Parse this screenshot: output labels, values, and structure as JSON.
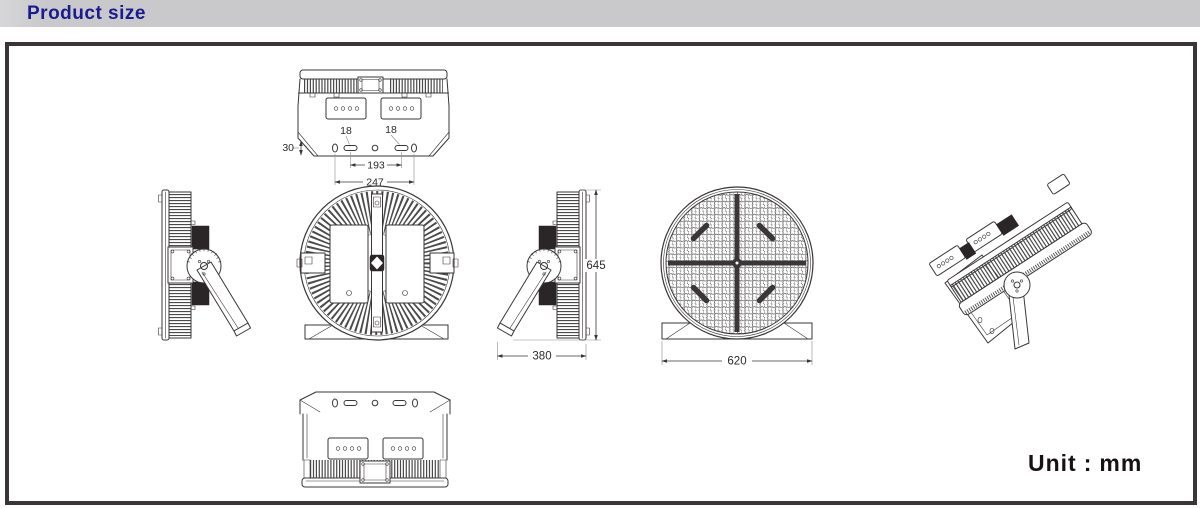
{
  "header": {
    "title": "Product size",
    "bar_color": "#c9c9cc",
    "title_color": "#1b1a8f"
  },
  "panel": {
    "border_color": "#3a3536",
    "background_color": "#ffffff",
    "line_art_color": "#3a3536"
  },
  "dimensions": {
    "top_view": {
      "plate_height": "30",
      "slot_left": "18",
      "slot_right": "18",
      "slot_spacing": "193",
      "mount_width": "247"
    },
    "side_view": {
      "depth": "380",
      "height": "645"
    },
    "front_view": {
      "diameter": "620"
    }
  },
  "footer": {
    "unit_prefix": "Unit",
    "unit_separator": ":",
    "unit_value": "mm"
  }
}
